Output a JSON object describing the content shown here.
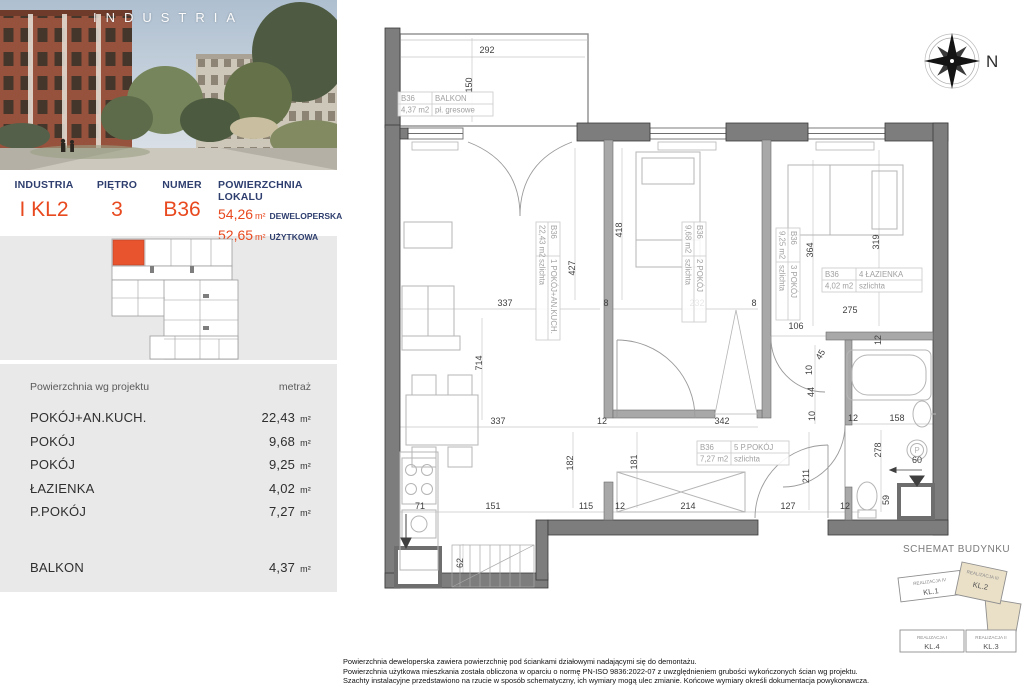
{
  "colors": {
    "accent": "#e8491f",
    "navy": "#2e3e6e",
    "panel_bg": "#e9e9e9",
    "unit_highlight": "#e8542e",
    "kl2_fill": "#eae0c8"
  },
  "photo": {
    "overlay_title": "INDUSTRIA"
  },
  "info_bar": {
    "project_label": "INDUSTRIA",
    "project_value": "I KL2",
    "floor_label": "PIĘTRO",
    "floor_value": "3",
    "number_label": "NUMER",
    "number_value": "B36",
    "area_label": "POWIERZCHNIA LOKALU",
    "areas": [
      {
        "value": "54,26",
        "unit": "m²",
        "type": "DEWELOPERSKA"
      },
      {
        "value": "52,65",
        "unit": "m²",
        "type": "UŻYTKOWA"
      }
    ]
  },
  "rooms_table": {
    "header_name": "Powierzchnia wg projektu",
    "header_area": "metraż",
    "rows": [
      {
        "name": "POKÓJ+AN.KUCH.",
        "area": "22,43",
        "unit": "m²"
      },
      {
        "name": "POKÓJ",
        "area": "9,68",
        "unit": "m²"
      },
      {
        "name": "POKÓJ",
        "area": "9,25",
        "unit": "m²"
      },
      {
        "name": "ŁAZIENKA",
        "area": "4,02",
        "unit": "m²"
      },
      {
        "name": "P.POKÓJ",
        "area": "7,27",
        "unit": "m²"
      },
      {
        "name": "BALKON",
        "area": "4,37",
        "unit": "m²"
      }
    ]
  },
  "plan": {
    "unit": "B36",
    "washer_symbol": "P",
    "room_labels": [
      {
        "unit": "B36",
        "name": "BALKON",
        "area": "4,37 m2",
        "finish": "pł. gresowe",
        "x": 398,
        "y": 92,
        "rot": 0,
        "w": 95
      },
      {
        "unit": "B36",
        "name": "1 POKÓJ+AN.KUCH.",
        "area": "22,43 m2",
        "finish": "szlichta",
        "x": 560,
        "y": 222,
        "rot": 90,
        "w": 118
      },
      {
        "unit": "B36",
        "name": "2 POKÓJ",
        "area": "9,68 m2",
        "finish": "szlichta",
        "x": 706,
        "y": 222,
        "rot": 90,
        "w": 100
      },
      {
        "unit": "B36",
        "name": "3 POKÓJ",
        "area": "9,25 m2",
        "finish": "szlichta",
        "x": 800,
        "y": 228,
        "rot": 90,
        "w": 92
      },
      {
        "unit": "B36",
        "name": "4 ŁAZIENKA",
        "area": "4,02 m2",
        "finish": "szlichta",
        "x": 822,
        "y": 268,
        "rot": 0,
        "w": 100
      },
      {
        "unit": "B36",
        "name": "5 P.POKÓJ",
        "area": "7,27 m2",
        "finish": "szlichta",
        "x": 697,
        "y": 441,
        "rot": 0,
        "w": 92
      }
    ],
    "dimensions": [
      {
        "t": "292",
        "x": 487,
        "y": 53,
        "r": 0
      },
      {
        "t": "150",
        "x": 472,
        "y": 85,
        "r": -90
      },
      {
        "t": "427",
        "x": 575,
        "y": 268,
        "r": -90
      },
      {
        "t": "337",
        "x": 505,
        "y": 306,
        "r": 0
      },
      {
        "t": "8",
        "x": 606,
        "y": 306,
        "r": 0
      },
      {
        "t": "714",
        "x": 482,
        "y": 363,
        "r": -90
      },
      {
        "t": "337",
        "x": 498,
        "y": 424,
        "r": 0
      },
      {
        "t": "12",
        "x": 602,
        "y": 424,
        "r": 0
      },
      {
        "t": "418",
        "x": 622,
        "y": 230,
        "r": -90
      },
      {
        "t": "232",
        "x": 697,
        "y": 306,
        "r": 0
      },
      {
        "t": "8",
        "x": 754,
        "y": 306,
        "r": 0
      },
      {
        "t": "364",
        "x": 813,
        "y": 250,
        "r": -90
      },
      {
        "t": "319",
        "x": 879,
        "y": 242,
        "r": -90
      },
      {
        "t": "275",
        "x": 850,
        "y": 313,
        "r": 0
      },
      {
        "t": "12",
        "x": 881,
        "y": 340,
        "r": -90
      },
      {
        "t": "106",
        "x": 796,
        "y": 329,
        "r": 0
      },
      {
        "t": "45",
        "x": 823,
        "y": 356,
        "r": -60
      },
      {
        "t": "10",
        "x": 812,
        "y": 370,
        "r": -90
      },
      {
        "t": "44",
        "x": 814,
        "y": 392,
        "r": -90
      },
      {
        "t": "10",
        "x": 815,
        "y": 416,
        "r": -90
      },
      {
        "t": "342",
        "x": 722,
        "y": 424,
        "r": 0
      },
      {
        "t": "182",
        "x": 573,
        "y": 463,
        "r": -90
      },
      {
        "t": "181",
        "x": 637,
        "y": 462,
        "r": -90
      },
      {
        "t": "211",
        "x": 809,
        "y": 476,
        "r": -90
      },
      {
        "t": "12",
        "x": 853,
        "y": 421,
        "r": 0
      },
      {
        "t": "158",
        "x": 897,
        "y": 421,
        "r": 0
      },
      {
        "t": "278",
        "x": 881,
        "y": 450,
        "r": -90
      },
      {
        "t": "60",
        "x": 917,
        "y": 463,
        "r": 0
      },
      {
        "t": "59",
        "x": 889,
        "y": 500,
        "r": -90
      },
      {
        "t": "71",
        "x": 420,
        "y": 509,
        "r": 0
      },
      {
        "t": "151",
        "x": 493,
        "y": 509,
        "r": 0
      },
      {
        "t": "115",
        "x": 586,
        "y": 509,
        "r": 0
      },
      {
        "t": "12",
        "x": 620,
        "y": 509,
        "r": 0
      },
      {
        "t": "214",
        "x": 688,
        "y": 509,
        "r": 0
      },
      {
        "t": "127",
        "x": 788,
        "y": 509,
        "r": 0
      },
      {
        "t": "12",
        "x": 845,
        "y": 509,
        "r": 0
      },
      {
        "t": "62",
        "x": 463,
        "y": 563,
        "r": -90
      }
    ]
  },
  "compass": {
    "north_label": "N"
  },
  "schemat": {
    "title": "SCHEMAT BUDYNKU",
    "blocks": [
      {
        "realizacja": "REALIZACJA IV",
        "kl": "KL.1",
        "highlight": false
      },
      {
        "realizacja": "REALIZACJA III",
        "kl": "KL.2",
        "highlight": true
      },
      {
        "realizacja": "REALIZACJA II",
        "kl": "KL.3",
        "highlight": false
      },
      {
        "realizacja": "REALIZACJA I",
        "kl": "KL.4",
        "highlight": false
      }
    ]
  },
  "footer": {
    "lines": [
      "Powierzchnia deweloperska zawiera powierzchnię pod ściankami działowymi nadającymi się do demontażu.",
      "Powierzchnia użytkowa mieszkania została obliczona w oparciu o normę  PN-ISO 9836:2022-07 z uwzględnieniem grubości wykończonych ścian wg projektu.",
      "Szachty instalacyjne przedstawiono na rzucie w sposób schematyczny, ich wymiary mogą ulec zmianie. Końcowe wymiary określi dokumentacja powykonawcza."
    ]
  }
}
